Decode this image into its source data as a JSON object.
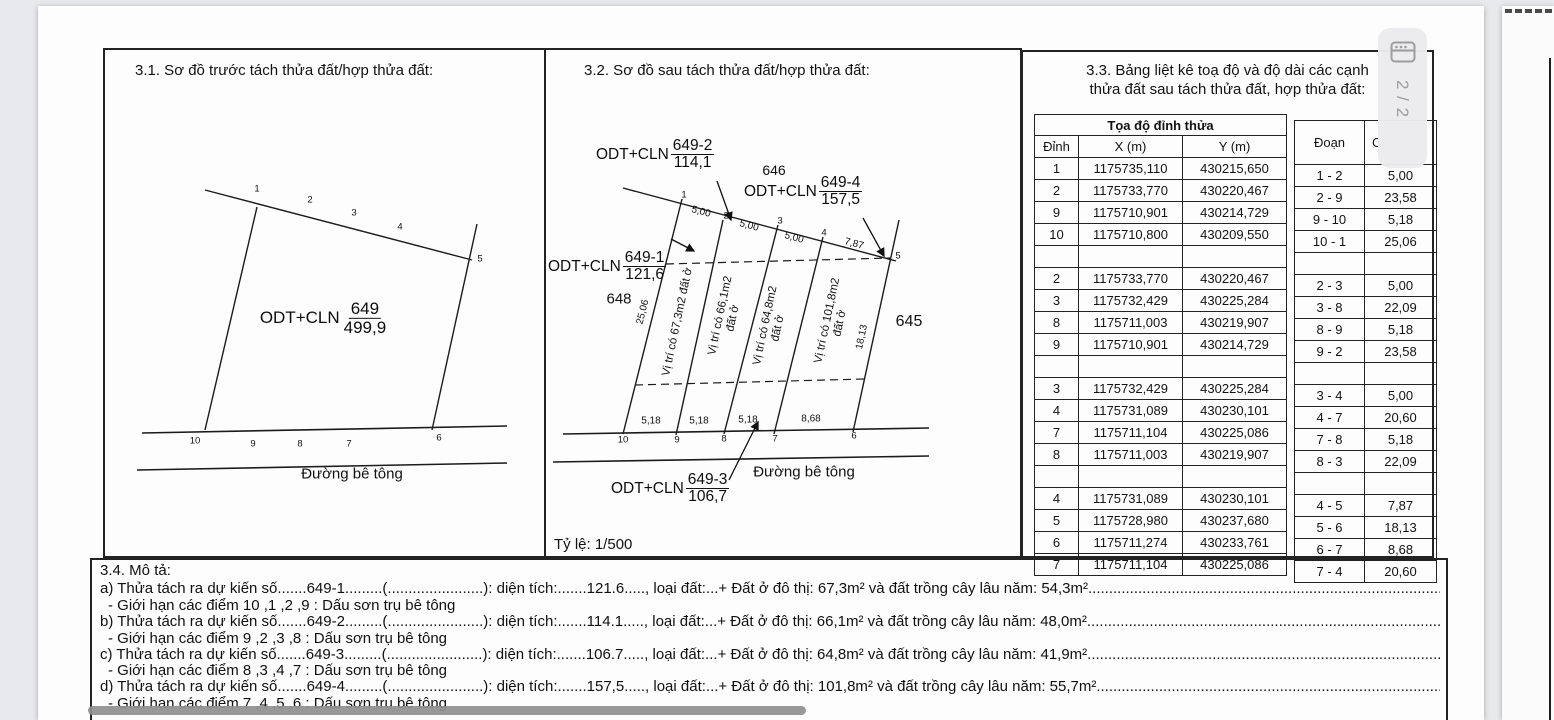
{
  "viewer": {
    "page_indicator": "2 / 2"
  },
  "sections": {
    "s31": {
      "title": "3.1. Sơ đồ trước tách thửa đất/hợp thửa đất:",
      "plot": {
        "prefix": "ODT+CLN",
        "code": "649",
        "area": "499,9"
      },
      "road_label": "Đường bê tông",
      "points_top": [
        "1",
        "2",
        "3",
        "4",
        "5"
      ],
      "points_bottom": [
        "10",
        "9",
        "8",
        "7",
        "6"
      ]
    },
    "s32": {
      "title": "3.2. Sơ đồ sau tách thửa đất/hợp thửa đất:",
      "scale": "Tỷ lệ: 1/500",
      "road_label": "Đường bê tông",
      "plots": [
        {
          "prefix": "ODT+CLN",
          "code": "649-1",
          "area": "121,6"
        },
        {
          "prefix": "ODT+CLN",
          "code": "649-2",
          "area": "114,1"
        },
        {
          "prefix": "ODT+CLN",
          "code": "649-3",
          "area": "106,7"
        },
        {
          "prefix": "ODT+CLN",
          "code": "649-4",
          "area": "157,5"
        }
      ],
      "neighbors": {
        "left": "648",
        "top": "646",
        "right": "645"
      },
      "inner_labels": [
        {
          "line1": "Vị trí có 67,3m2 đất ở",
          "line2": ""
        },
        {
          "line1": "Vị trí có 66,1m2",
          "line2": "đất ở"
        },
        {
          "line1": "Vị trí có 64,8m2",
          "line2": "đất ở"
        },
        {
          "line1": "Vị trí có 101,8m2",
          "line2": "đất ở"
        }
      ],
      "dims_top": [
        "5,00",
        "5,00",
        "5,00",
        "7,87"
      ],
      "dims_bottom": [
        "5,18",
        "5,18",
        "5,18",
        "8,68"
      ],
      "dim_left": "25,06",
      "dim_right": "18,13",
      "points_top": [
        "1",
        "2",
        "3",
        "4",
        "5"
      ],
      "points_bottom": [
        "10",
        "9",
        "8",
        "7",
        "6"
      ]
    },
    "s33": {
      "title_line1": "3.3. Bảng liệt kê toạ độ và độ dài các cạnh",
      "title_line2": "thửa đất sau tách thửa đất, hợp thửa đất:",
      "coord_table": {
        "header_group": "Tọa độ đỉnh thửa",
        "headers": [
          "Đỉnh",
          "X (m)",
          "Y (m)"
        ],
        "rows": [
          [
            "1",
            "1175735,110",
            "430215,650"
          ],
          [
            "2",
            "1175733,770",
            "430220,467"
          ],
          [
            "9",
            "1175710,901",
            "430214,729"
          ],
          [
            "10",
            "1175710,800",
            "430209,550"
          ],
          [
            "",
            "",
            ""
          ],
          [
            "2",
            "1175733,770",
            "430220,467"
          ],
          [
            "3",
            "1175732,429",
            "430225,284"
          ],
          [
            "8",
            "1175711,003",
            "430219,907"
          ],
          [
            "9",
            "1175710,901",
            "430214,729"
          ],
          [
            "",
            "",
            ""
          ],
          [
            "3",
            "1175732,429",
            "430225,284"
          ],
          [
            "4",
            "1175731,089",
            "430230,101"
          ],
          [
            "7",
            "1175711,104",
            "430225,086"
          ],
          [
            "8",
            "1175711,003",
            "430219,907"
          ],
          [
            "",
            "",
            ""
          ],
          [
            "4",
            "1175731,089",
            "430230,101"
          ],
          [
            "5",
            "1175728,980",
            "430237,680"
          ],
          [
            "6",
            "1175711,274",
            "430233,761"
          ],
          [
            "7",
            "1175711,104",
            "430225,086"
          ]
        ]
      },
      "segment_table": {
        "headers": [
          "Đoạn",
          "C"
        ],
        "rows": [
          [
            "1 - 2",
            "5,00"
          ],
          [
            "2 - 9",
            "23,58"
          ],
          [
            "9 - 10",
            "5,18"
          ],
          [
            "10 - 1",
            "25,06"
          ],
          [
            "",
            ""
          ],
          [
            "2 - 3",
            "5,00"
          ],
          [
            "3 - 8",
            "22,09"
          ],
          [
            "8 - 9",
            "5,18"
          ],
          [
            "9 - 2",
            "23,58"
          ],
          [
            "",
            ""
          ],
          [
            "3 - 4",
            "5,00"
          ],
          [
            "4 - 7",
            "20,60"
          ],
          [
            "7 - 8",
            "5,18"
          ],
          [
            "8 - 3",
            "22,09"
          ],
          [
            "",
            ""
          ],
          [
            "4 - 5",
            "7,87"
          ],
          [
            "5 - 6",
            "18,13"
          ],
          [
            "6 - 7",
            "8,68"
          ],
          [
            "7 - 4",
            "20,60"
          ]
        ]
      }
    },
    "s34": {
      "title": "3.4. Mô tả:",
      "items": [
        {
          "line": "a) Thửa tách ra dự kiến số.......649-1.........(.......................): diện tích:.......121.6....., loại đất:...+ Đất ở đô thị: 67,3m² và đất trồng cây lâu năm: 54,3m²...........................................................................................",
          "sub": "- Giới hạn các điểm 10 ,1 ,2 ,9  : Dấu sơn trụ bê tông"
        },
        {
          "line": "b) Thửa tách ra dự kiến số.......649-2.........(.......................): diện tích:.......114.1....., loại đất:...+ Đất ở đô thị: 66,1m² và đất trồng cây lâu năm: 48,0m²...........................................................................................",
          "sub": "- Giới hạn các điểm 9 ,2 ,3 ,8  : Dấu sơn trụ bê tông"
        },
        {
          "line": "c) Thửa tách ra dự kiến số.......649-3.........(.......................): diện tích:.......106.7....., loại đất:...+ Đất ở đô thị: 64,8m² và đất trồng cây lâu năm: 41,9m²...........................................................................................",
          "sub": "- Giới hạn các điểm 8 ,3 ,4 ,7  : Dấu sơn trụ bê tông"
        },
        {
          "line": "d) Thửa tách ra dự kiến số.......649-4.........(.......................): diện tích:.......157,5....., loại đất:...+ Đất ở đô thị: 101,8m² và đất trồng cây lâu năm: 55,7m²..........................................................................................",
          "sub": "- Giới hạn các điểm 7 ,4 ,5 ,6  : Dấu sơn trụ bê tông"
        }
      ]
    }
  }
}
